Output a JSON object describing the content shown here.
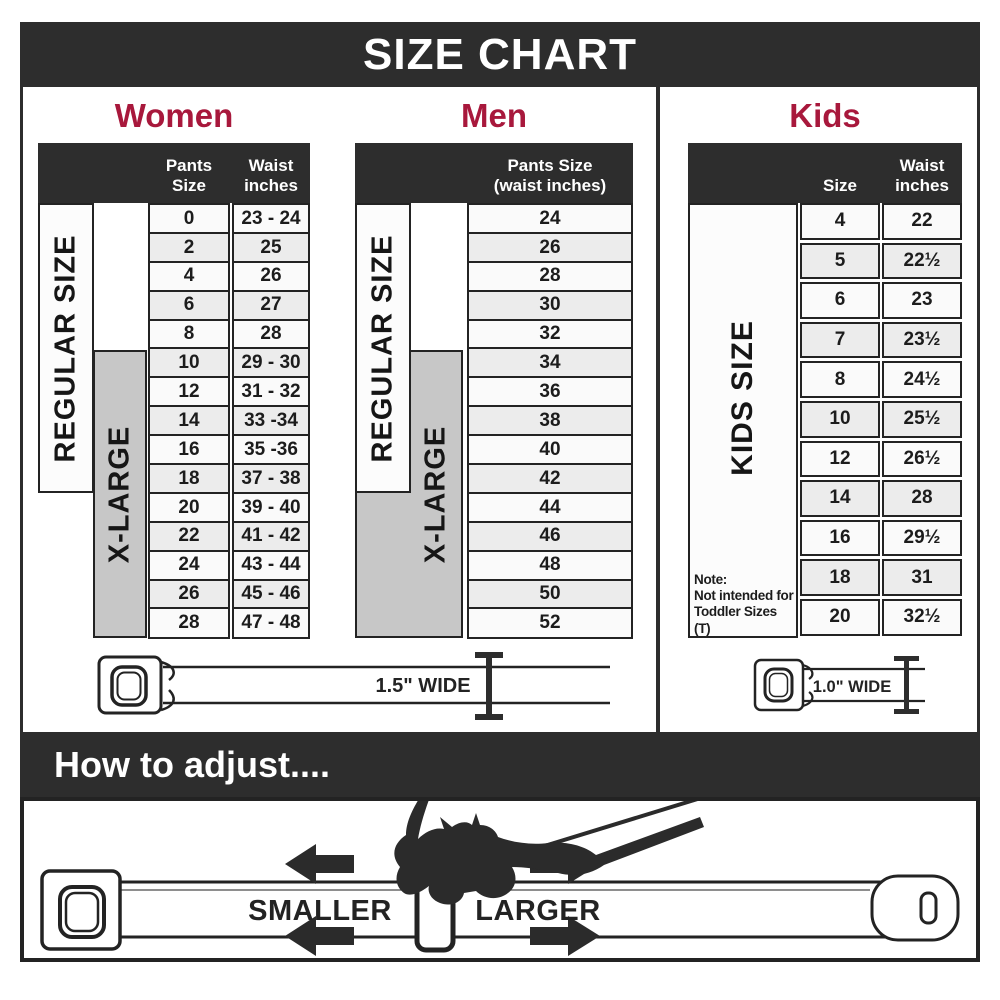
{
  "title": "SIZE CHART",
  "colors": {
    "dark": "#2d2d2d",
    "accent_red": "#a8183c",
    "gray_box": "#c7c7c7",
    "row_alt": "#ececec"
  },
  "sections": {
    "women": {
      "label": "Women",
      "col1": "Pants Size",
      "col2_line1": "Waist",
      "col2_line2": "inches",
      "regular_label": "REGULAR SIZE",
      "xl_label": "X-LARGE",
      "rows": [
        {
          "size": "0",
          "waist": "23 - 24"
        },
        {
          "size": "2",
          "waist": "25"
        },
        {
          "size": "4",
          "waist": "26"
        },
        {
          "size": "6",
          "waist": "27"
        },
        {
          "size": "8",
          "waist": "28"
        },
        {
          "size": "10",
          "waist": "29 - 30"
        },
        {
          "size": "12",
          "waist": "31 - 32"
        },
        {
          "size": "14",
          "waist": "33 -34"
        },
        {
          "size": "16",
          "waist": "35 -36"
        },
        {
          "size": "18",
          "waist": "37 - 38"
        },
        {
          "size": "20",
          "waist": "39 - 40"
        },
        {
          "size": "22",
          "waist": "41 - 42"
        },
        {
          "size": "24",
          "waist": "43 - 44"
        },
        {
          "size": "26",
          "waist": "45 - 46"
        },
        {
          "size": "28",
          "waist": "47 - 48"
        }
      ],
      "belt_label": "1.5\" WIDE"
    },
    "men": {
      "label": "Men",
      "header_line1": "Pants Size",
      "header_line2": "(waist inches)",
      "regular_label": "REGULAR SIZE",
      "xl_label": "X-LARGE",
      "rows": [
        "24",
        "26",
        "28",
        "30",
        "32",
        "34",
        "36",
        "38",
        "40",
        "42",
        "44",
        "46",
        "48",
        "50",
        "52"
      ]
    },
    "kids": {
      "label": "Kids",
      "col1": "Size",
      "col2_line1": "Waist",
      "col2_line2": "inches",
      "side_label": "KIDS SIZE",
      "rows": [
        {
          "size": "4",
          "waist": "22"
        },
        {
          "size": "5",
          "waist": "22½"
        },
        {
          "size": "6",
          "waist": "23"
        },
        {
          "size": "7",
          "waist": "23½"
        },
        {
          "size": "8",
          "waist": "24½"
        },
        {
          "size": "10",
          "waist": "25½"
        },
        {
          "size": "12",
          "waist": "26½"
        },
        {
          "size": "14",
          "waist": "28"
        },
        {
          "size": "16",
          "waist": "29½"
        },
        {
          "size": "18",
          "waist": "31"
        },
        {
          "size": "20",
          "waist": "32½"
        }
      ],
      "note_line1": "Note:",
      "note_line2": "Not intended for",
      "note_line3": "Toddler Sizes (T)",
      "belt_label": "1.0\" WIDE"
    }
  },
  "adjust": {
    "title": "How to adjust....",
    "smaller_label": "SMALLER",
    "larger_label": "LARGER"
  }
}
